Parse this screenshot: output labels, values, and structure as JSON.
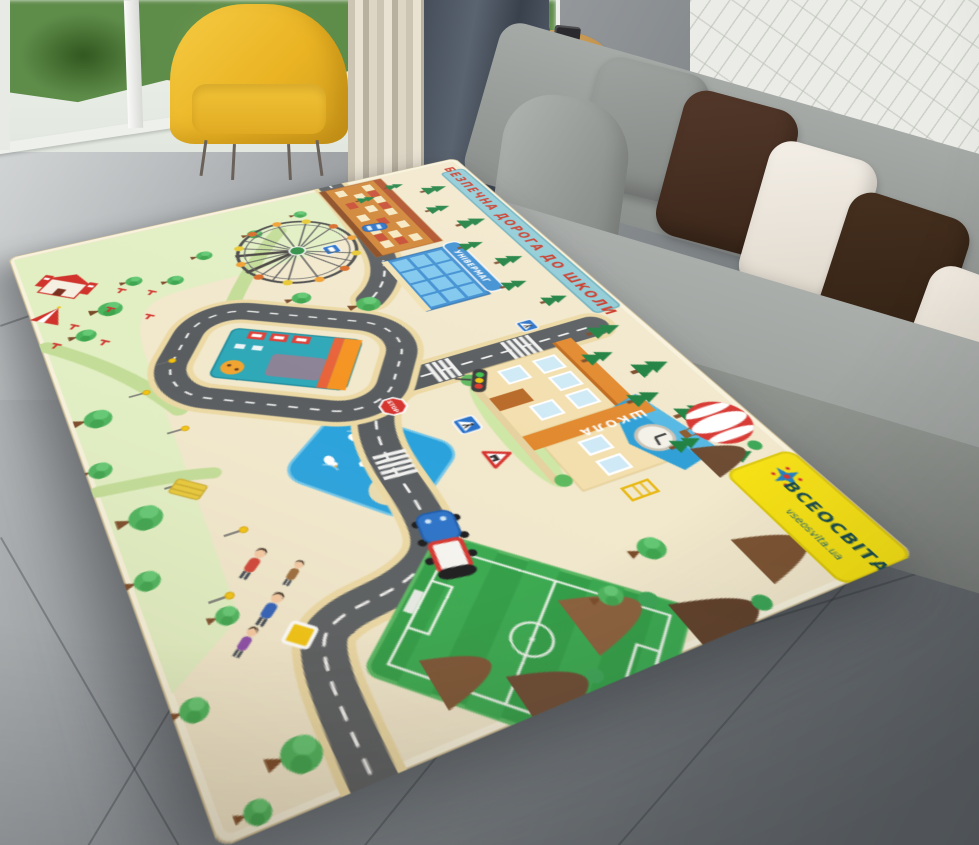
{
  "scene": {
    "description": "Product photo of a children's city road play rug lying in perspective on a gray tiled living-room floor",
    "room": {
      "furniture": [
        "floor-to-ceiling window with greenery",
        "yellow armchair",
        "round wooden side table with camera and books",
        "beige pleated curtain",
        "dark gray curtain",
        "gray fabric sofa with pillows",
        "white painted brick wall"
      ],
      "pillow_colors": [
        "#8f9492",
        "#46301f",
        "#f2ece2"
      ],
      "armchair_color": "#eab424",
      "floor_color": "#8d9296"
    }
  },
  "rug": {
    "top_banner_text": "БЕЗПЕЧНА ДОРОГА ДО ШКОЛИ",
    "school_sign_text": "ШКОЛА",
    "store_sign_text": "УНІВЕРМАГ",
    "stop_sign_text": "STOP",
    "brand_name": "ВСЕОСВІТА",
    "brand_url": "vseosvita.ua",
    "features": [
      "ferris wheel",
      "circus castle and tent",
      "park with trees, lamps and people",
      "bus station inside road loop",
      "pond with ducks and birdhouse island",
      "school with clock tower",
      "department store",
      "apartment building",
      "traffic light",
      "pedestrian crossings",
      "stop sign",
      "warning signs",
      "soccer field",
      "hot air balloon",
      "wooded brown hills",
      "toy truck",
      "blue car"
    ],
    "colors": {
      "base": "#f2e8cc",
      "road": "#595d60",
      "park": "#e2efc3",
      "pond": "#2aa2dc",
      "field": "#2f9e45",
      "banner_bg": "#8fcbd6",
      "banner_text": "#c93423",
      "brand_bg": "#f6e113"
    }
  }
}
